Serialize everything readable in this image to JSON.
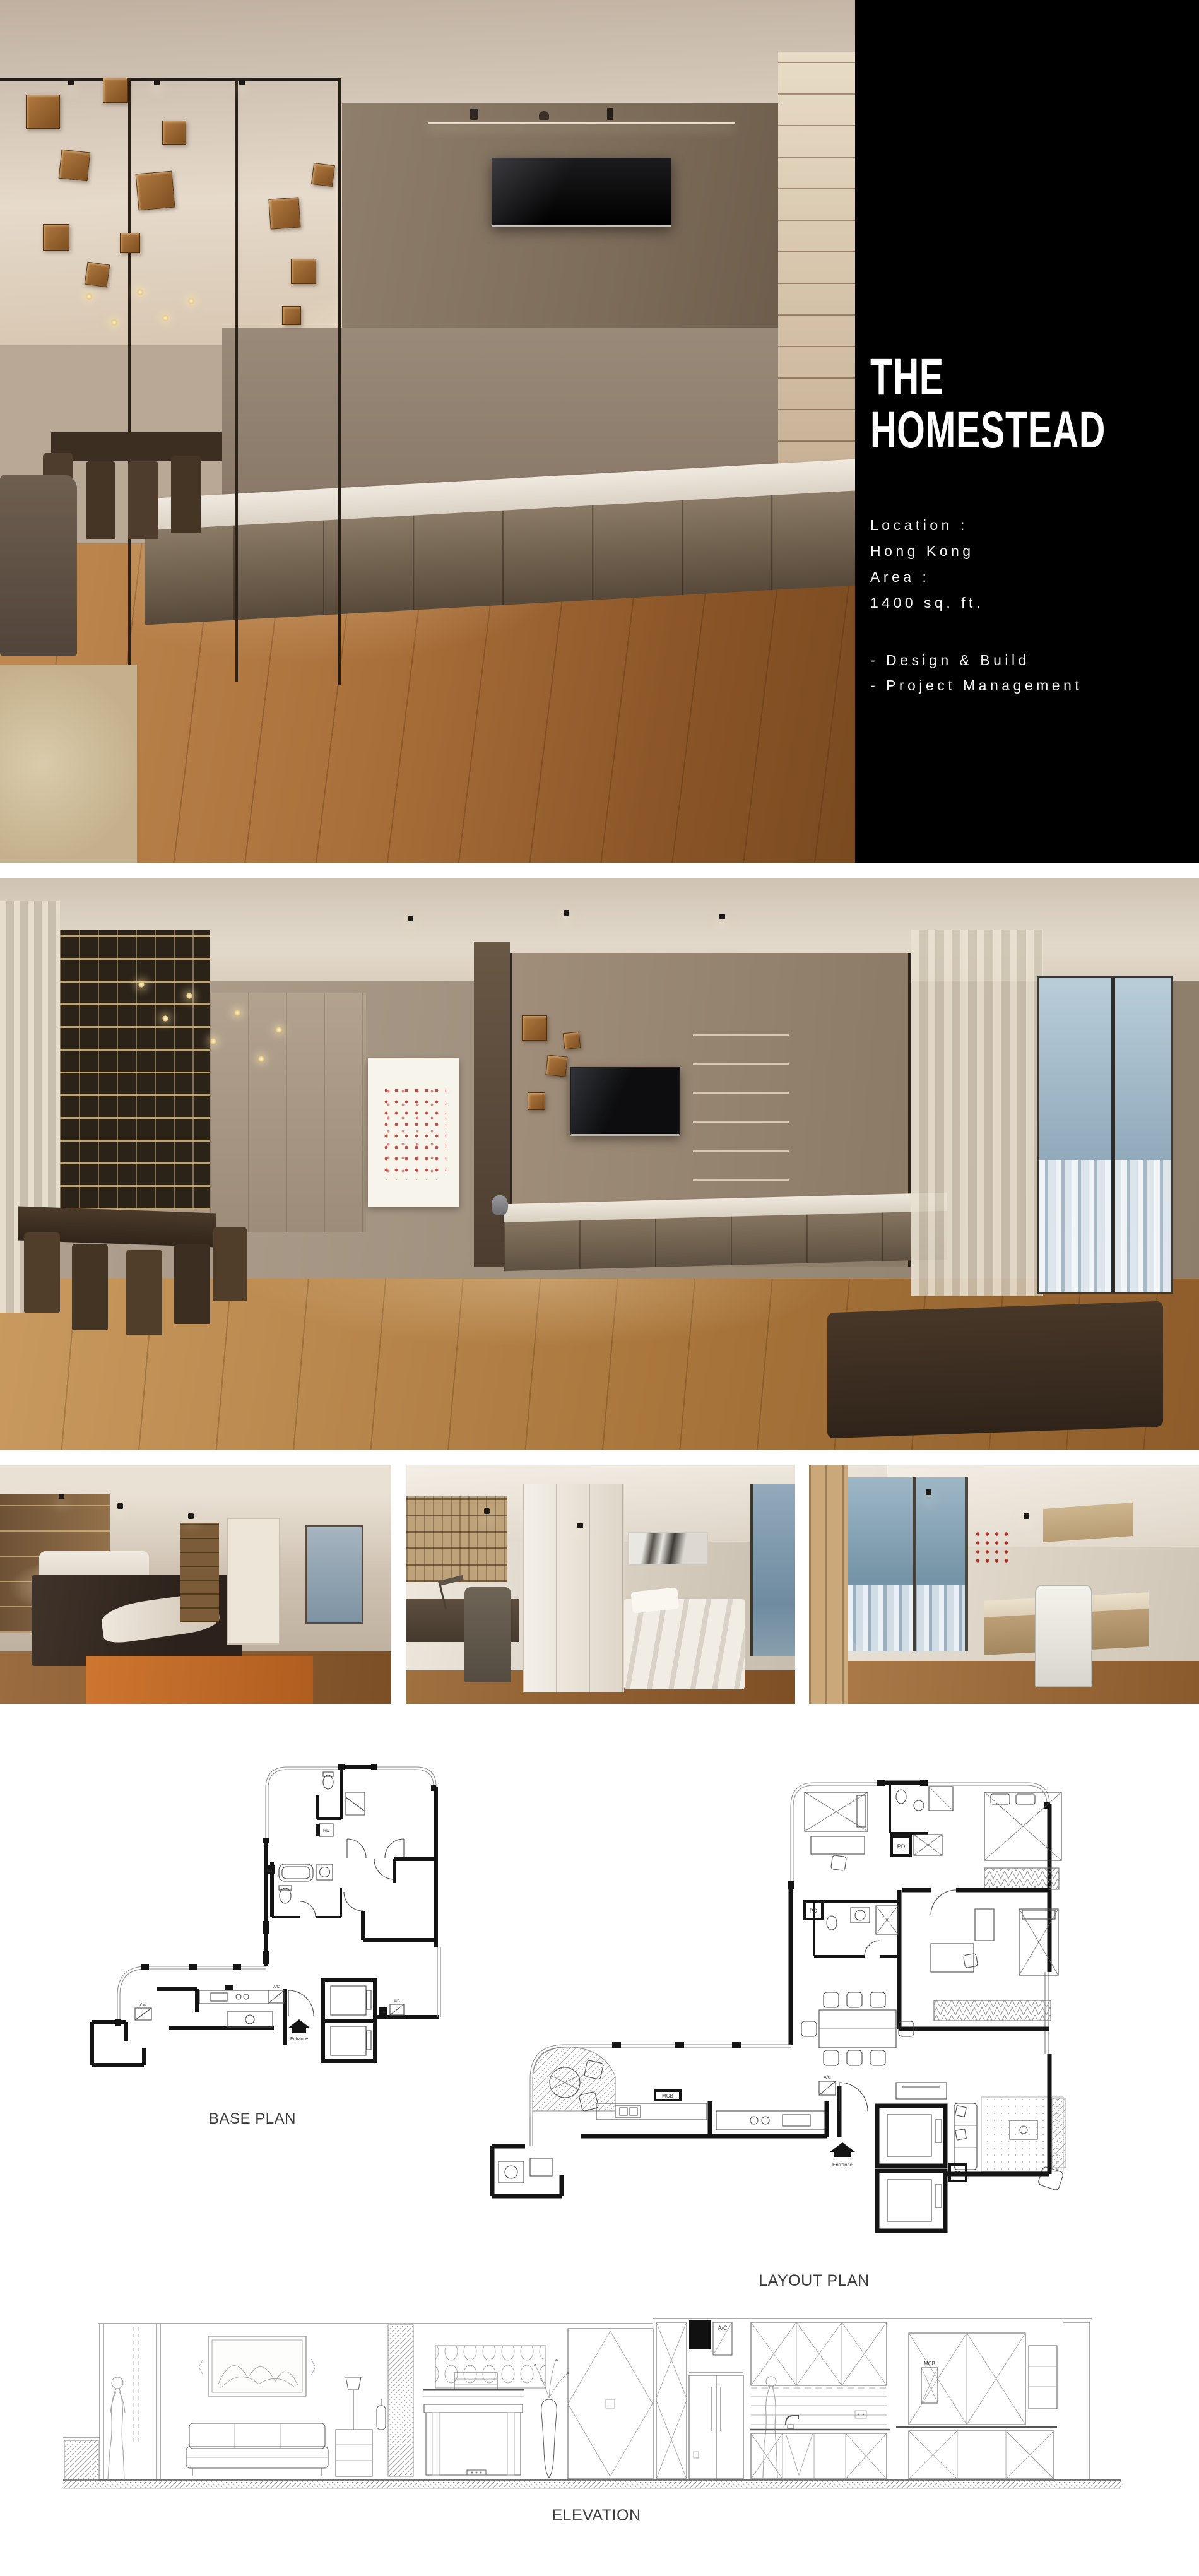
{
  "palette": {
    "page_background": "#ffffff",
    "panel_background": "#000000",
    "panel_text": "#ffffff",
    "drawing_ink": "#141414",
    "label_color": "#3b3b3b",
    "wood_accent": "#9c6a3a"
  },
  "info_panel": {
    "title_line1": "THE",
    "title_line2": "HOMESTEAD",
    "meta": [
      {
        "text": "Location :"
      },
      {
        "text": "Hong Kong"
      },
      {
        "text": "Area :"
      },
      {
        "text": "1400 sq. ft."
      }
    ],
    "services": [
      {
        "text": "- Design & Build"
      },
      {
        "text": "- Project Management"
      }
    ]
  },
  "gallery": {
    "hero": {
      "description": "Living room render with TV feature wall, marble console, glass partition and hanging wood cubes"
    },
    "wide_photo": {
      "description": "Dining room render with full-height bookshelf wall, pendant lights, dot artwork, TV lounge and city window"
    },
    "thumbnails": [
      {
        "description": "Master bedroom render with dark bed, fur throw and orange rug"
      },
      {
        "description": "Study bedroom render with desk, shelving and single bed"
      },
      {
        "description": "Home office render with curved city-view window and desk chair"
      }
    ]
  },
  "drawings": {
    "base_plan": {
      "label": "BASE PLAN",
      "annotations": {
        "entrance": "Entrance",
        "ac": "A/C",
        "rd": "RD",
        "cw": "CW"
      }
    },
    "layout_plan": {
      "label": "LAYOUT PLAN",
      "annotations": {
        "entrance": "Entrance",
        "ac": "A/C",
        "pd": "PD",
        "mcb": "MCB"
      }
    },
    "elevation": {
      "label": "ELEVATION",
      "annotations": {
        "ac": "A/C",
        "mcb": "MCB"
      }
    }
  }
}
